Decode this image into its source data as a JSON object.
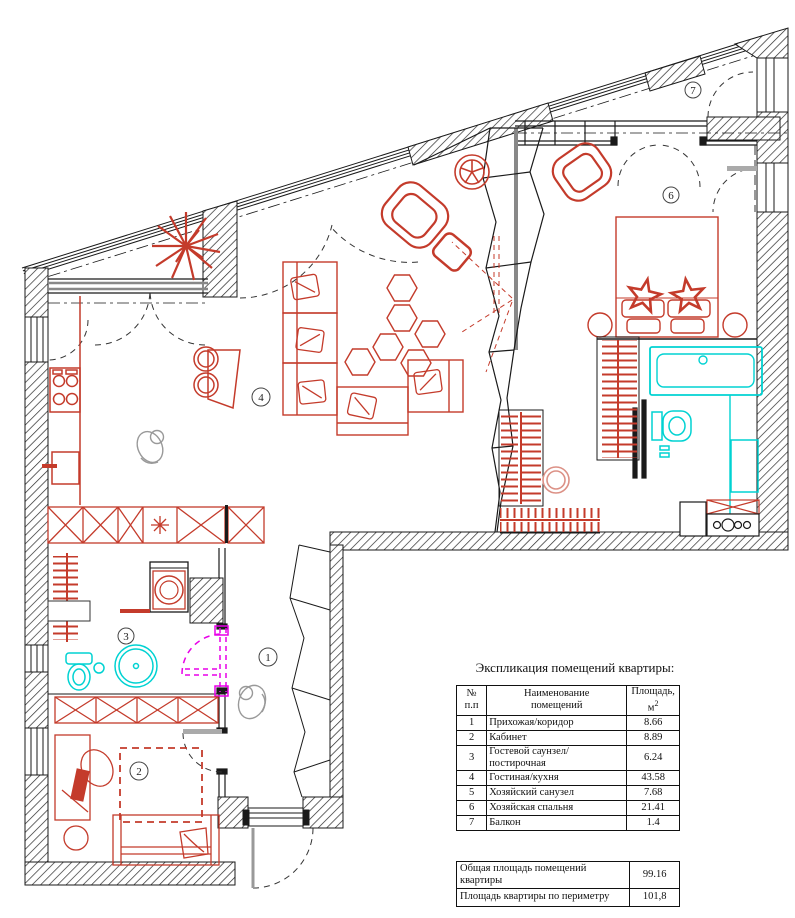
{
  "explication": {
    "title": "Экспликация помещений квартиры:",
    "headers": {
      "num_line1": "№",
      "num_line2": "п.п",
      "name_line1": "Наименование",
      "name_line2": "помещений",
      "area_line1": "Площадь,",
      "area_unit": "м",
      "area_sup": "2"
    },
    "rows": [
      {
        "num": "1",
        "name": "Прихожая/коридор",
        "area": "8.66"
      },
      {
        "num": "2",
        "name": "Кабинет",
        "area": "8.89"
      },
      {
        "num": "3",
        "name": "Гостевой саунзел/постирочная",
        "area": "6.24"
      },
      {
        "num": "4",
        "name": "Гостиная/кухня",
        "area": "43.58"
      },
      {
        "num": "5",
        "name": "Хозяйский санузел",
        "area": "7.68"
      },
      {
        "num": "6",
        "name": "Хозяйская спальня",
        "area": "21.41"
      },
      {
        "num": "7",
        "name": "Балкон",
        "area": "1.4"
      }
    ],
    "summary": [
      {
        "label": "Общая площадь помещений квартиры",
        "value": "99.16"
      },
      {
        "label": "Площадь квартиры по периметру",
        "value": "101,8"
      }
    ]
  },
  "plan": {
    "room_numbers": {
      "hallway": "1",
      "cabinet": "2",
      "guest_bath": "3",
      "living_kitchen": "4",
      "master_bedroom": "6",
      "balcony": "7"
    },
    "colors": {
      "furniture_red": "#c43b2b",
      "plumbing_cyan": "#00d2d2",
      "door_magenta": "#e800e8",
      "wall_black": "#1a1a1a",
      "sketch_gray": "#999999"
    }
  }
}
